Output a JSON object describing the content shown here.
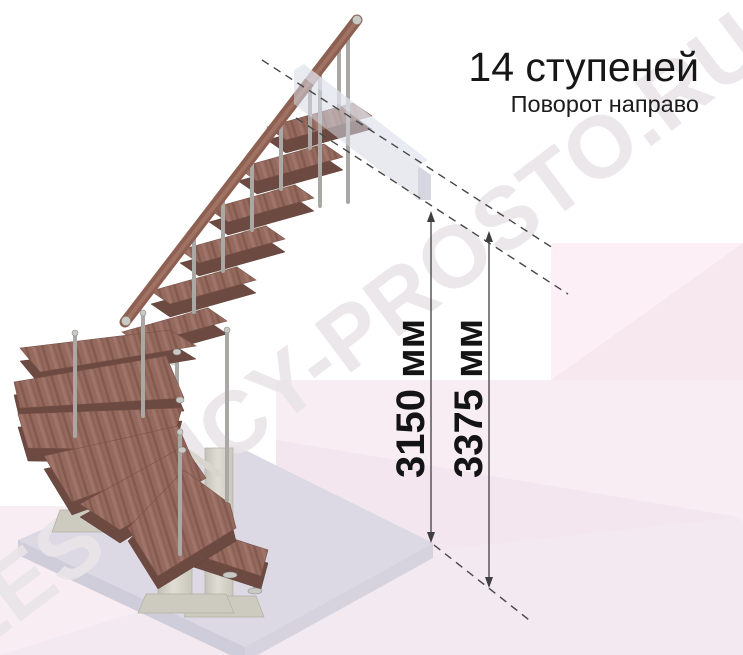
{
  "header": {
    "title": "14 ступеней",
    "subtitle": "Поворот направо"
  },
  "dimensions": {
    "inner": "3150 мм",
    "outer": "3375 мм"
  },
  "watermark": {
    "text": "LESTNICY-PROSTO.RU"
  },
  "stairs": {
    "step_count": 14,
    "turn_direction": "направо"
  },
  "colors": {
    "wood": "#956a5e",
    "wood_edge": "#6d4a41",
    "metal": "#a9a8a5",
    "support_beige": "#d8d5cc",
    "platform": "#dcd9e5",
    "upper_slab": "#d5d8e3",
    "backdrop_pink": "#f8edf3",
    "backdrop_pink_light": "#fcf0f6",
    "dimension_line": "#3f3f3f",
    "text": "#161616",
    "watermark": "#e9e5e8"
  }
}
